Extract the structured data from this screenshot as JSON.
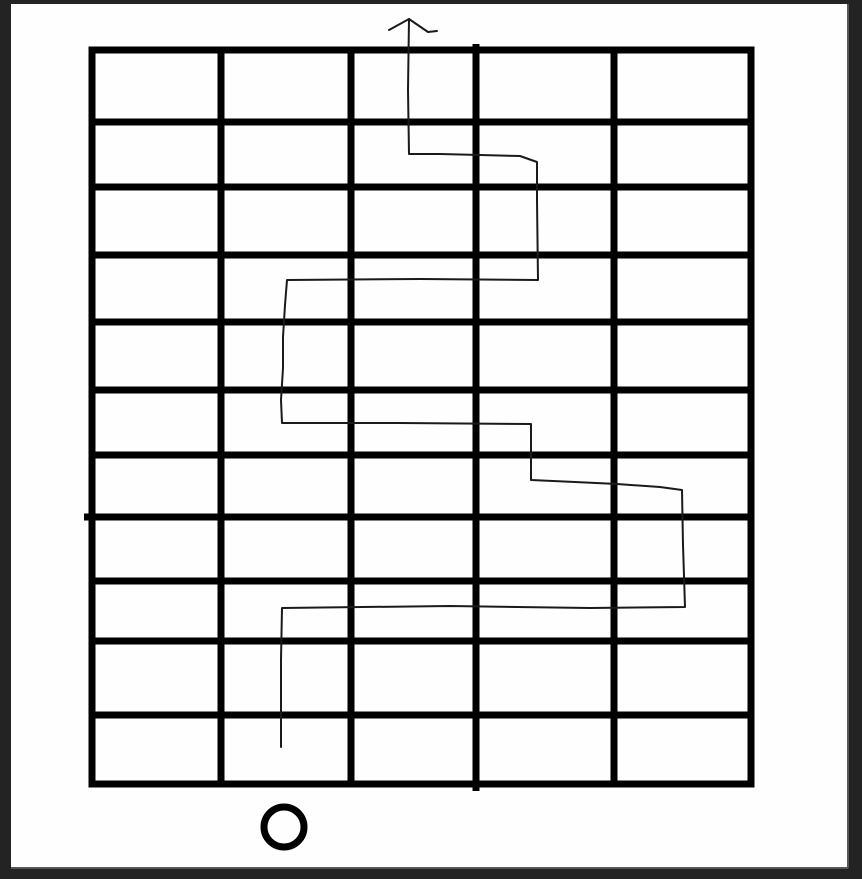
{
  "scene": {
    "width": 862,
    "height": 879,
    "frame_color": "#232323",
    "paper": {
      "x": 11,
      "y": 4,
      "width": 837,
      "height": 864,
      "color": "#fefefe",
      "edge_color": "#565656"
    }
  },
  "grid": {
    "color": "#000000",
    "thickness": 7,
    "columns": 5,
    "rows": 11,
    "extent": {
      "x1": 88.5,
      "x2": 754.5,
      "y1": 46.5,
      "y2": 787.5
    },
    "v_lines": [
      {
        "x": 92
      },
      {
        "x": 221
      },
      {
        "x": 351
      },
      {
        "x": 476,
        "y1": 44,
        "y2": 791
      },
      {
        "x": 614
      },
      {
        "x": 751
      }
    ],
    "h_lines": [
      {
        "y": 50
      },
      {
        "y": 122
      },
      {
        "y": 187
      },
      {
        "y": 255
      },
      {
        "y": 322
      },
      {
        "y": 390
      },
      {
        "y": 455
      },
      {
        "y": 517,
        "x1": 84
      },
      {
        "y": 581
      },
      {
        "y": 641
      },
      {
        "y": 715
      },
      {
        "y": 784
      }
    ]
  },
  "route": {
    "color": "#1a1a1a",
    "thickness": 2,
    "points": [
      [
        281,
        747
      ],
      [
        281,
        660
      ],
      [
        282,
        608
      ],
      [
        450,
        606
      ],
      [
        590,
        608
      ],
      [
        685,
        607
      ],
      [
        683,
        545
      ],
      [
        682,
        490
      ],
      [
        660,
        487
      ],
      [
        617,
        484
      ],
      [
        575,
        482
      ],
      [
        531,
        480
      ],
      [
        531,
        424
      ],
      [
        400,
        423
      ],
      [
        282,
        423
      ],
      [
        281,
        400
      ],
      [
        283,
        368
      ],
      [
        283,
        337
      ],
      [
        285,
        305
      ],
      [
        287,
        280
      ],
      [
        420,
        279
      ],
      [
        538,
        280
      ],
      [
        537,
        200
      ],
      [
        537,
        162
      ],
      [
        520,
        156
      ],
      [
        480,
        155
      ],
      [
        440,
        154
      ],
      [
        409,
        154
      ],
      [
        408,
        90
      ],
      [
        409,
        19
      ]
    ]
  },
  "arrow": {
    "tip": [
      409,
      19
    ],
    "left_wing_end": [
      389,
      30
    ],
    "right_wing_end": [
      428,
      32
    ],
    "right_tail_end": [
      437,
      31
    ]
  },
  "start_marker": {
    "shape": "circle",
    "cx": 284,
    "cy": 827,
    "r": 20,
    "thickness": 7,
    "color": "#000000"
  }
}
